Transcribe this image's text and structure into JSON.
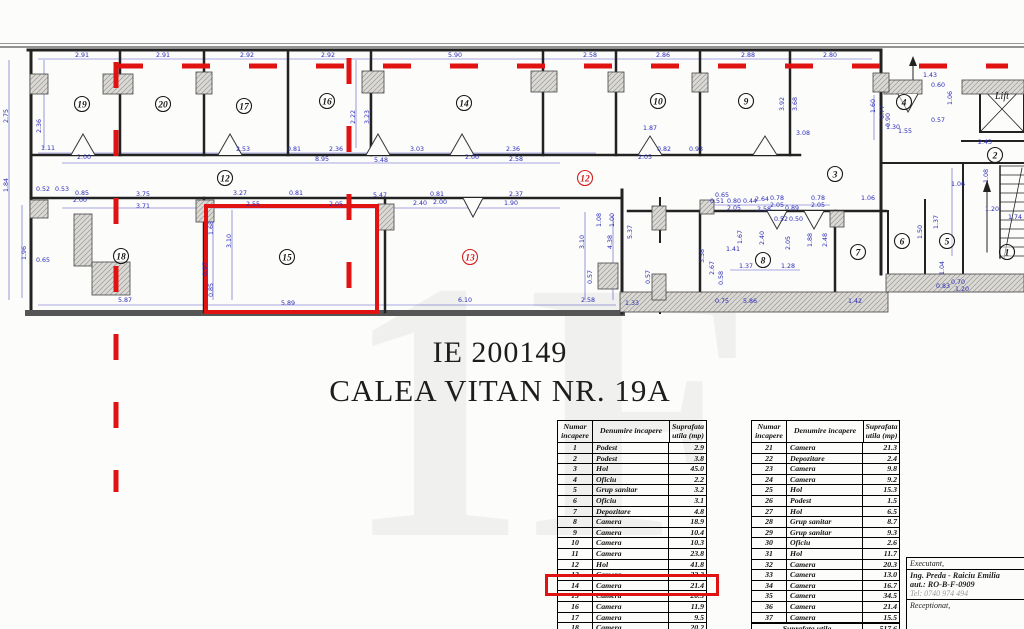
{
  "title": {
    "line1": "IE 200149",
    "line2": "CALEA VITAN NR. 19A"
  },
  "watermark": "1F",
  "colors": {
    "dim_blue": "#2a2ab8",
    "red": "#e01212",
    "wall": "#222222"
  },
  "plan": {
    "lift_label": "Lift",
    "rooms": [
      {
        "n": "19",
        "x": 82,
        "y": 104
      },
      {
        "n": "20",
        "x": 163,
        "y": 104
      },
      {
        "n": "17",
        "x": 244,
        "y": 106
      },
      {
        "n": "16",
        "x": 327,
        "y": 101
      },
      {
        "n": "14",
        "x": 464,
        "y": 103
      },
      {
        "n": "10",
        "x": 658,
        "y": 101
      },
      {
        "n": "9",
        "x": 746,
        "y": 101
      },
      {
        "n": "4",
        "x": 904,
        "y": 102
      },
      {
        "n": "3",
        "x": 835,
        "y": 174
      },
      {
        "n": "2",
        "x": 995,
        "y": 155
      },
      {
        "n": "12",
        "x": 225,
        "y": 178
      },
      {
        "n": "18",
        "x": 121,
        "y": 256
      },
      {
        "n": "15",
        "x": 287,
        "y": 257
      },
      {
        "n": "8",
        "x": 763,
        "y": 260
      },
      {
        "n": "7",
        "x": 858,
        "y": 252
      },
      {
        "n": "6",
        "x": 902,
        "y": 241
      },
      {
        "n": "5",
        "x": 947,
        "y": 241
      },
      {
        "n": "1",
        "x": 1007,
        "y": 252
      }
    ],
    "red_rooms": [
      {
        "n": "12",
        "x": 585,
        "y": 178
      },
      {
        "n": "13",
        "x": 470,
        "y": 257
      }
    ],
    "dimensions": [
      [
        "2.91",
        82,
        57
      ],
      [
        "2.91",
        163,
        57
      ],
      [
        "2.92",
        247,
        57
      ],
      [
        "2.92",
        328,
        57
      ],
      [
        "5.90",
        455,
        57
      ],
      [
        "2.58",
        590,
        57
      ],
      [
        "2.86",
        663,
        57
      ],
      [
        "2.88",
        748,
        57
      ],
      [
        "2.80",
        830,
        57
      ],
      [
        "1.43",
        930,
        77
      ],
      [
        "0.60",
        938,
        87
      ],
      [
        "1.87",
        650,
        130
      ],
      [
        "3.08",
        803,
        135
      ],
      [
        "2.43",
        985,
        144
      ],
      [
        "1.30",
        893,
        129
      ],
      [
        "1.55",
        905,
        133
      ],
      [
        "0.57",
        938,
        122
      ],
      [
        "1.06",
        958,
        186
      ],
      [
        "1.11",
        48,
        150
      ],
      [
        "2.00",
        84,
        159
      ],
      [
        "2.53",
        243,
        151
      ],
      [
        "0.81",
        294,
        151
      ],
      [
        "2.36",
        336,
        151
      ],
      [
        "8.95",
        322,
        161
      ],
      [
        "5.48",
        381,
        162
      ],
      [
        "3.03",
        417,
        151
      ],
      [
        "2.00",
        472,
        159
      ],
      [
        "2.36",
        513,
        151
      ],
      [
        "2.58",
        516,
        161
      ],
      [
        "2.05",
        645,
        159
      ],
      [
        "0.82",
        664,
        151
      ],
      [
        "0.93",
        696,
        151
      ],
      [
        "0.52",
        43,
        191
      ],
      [
        "0.53",
        62,
        191
      ],
      [
        "0.85",
        82,
        195
      ],
      [
        "2.00",
        80,
        202
      ],
      [
        "3.75",
        143,
        196
      ],
      [
        "3.71",
        143,
        208
      ],
      [
        "3.27",
        240,
        195
      ],
      [
        "0.81",
        296,
        195
      ],
      [
        "2.55",
        253,
        206
      ],
      [
        "2.05",
        336,
        206
      ],
      [
        "5.47",
        380,
        197
      ],
      [
        "0.81",
        437,
        196
      ],
      [
        "2.00",
        440,
        204
      ],
      [
        "2.37",
        516,
        196
      ],
      [
        "1.90",
        511,
        205
      ],
      [
        "2.40",
        420,
        205
      ],
      [
        "0.65",
        722,
        197
      ],
      [
        "2.64",
        762,
        201
      ],
      [
        "2.58",
        764,
        211
      ],
      [
        "1.20",
        992,
        211
      ],
      [
        "1.74",
        1015,
        219
      ],
      [
        "0.51",
        717,
        203
      ],
      [
        "0.80",
        734,
        203
      ],
      [
        "0.44",
        750,
        203
      ],
      [
        "2.05",
        734,
        210
      ],
      [
        "0.78",
        777,
        200
      ],
      [
        "2.05",
        777,
        207
      ],
      [
        "0.89",
        792,
        210
      ],
      [
        "0.78",
        818,
        200
      ],
      [
        "2.05",
        818,
        207
      ],
      [
        "0.50",
        796,
        221
      ],
      [
        "0.52",
        781,
        221
      ],
      [
        "1.37",
        746,
        268
      ],
      [
        "1.28",
        788,
        268
      ],
      [
        "1.41",
        733,
        251
      ],
      [
        "1.06",
        868,
        200
      ],
      [
        "0.83",
        943,
        288
      ],
      [
        "1.20",
        962,
        291
      ],
      [
        "0.70",
        958,
        284
      ],
      [
        "5.87",
        125,
        302
      ],
      [
        "5.89",
        288,
        305
      ],
      [
        "6.10",
        465,
        302
      ],
      [
        "2.58",
        588,
        302
      ],
      [
        "1.33",
        632,
        305
      ],
      [
        "5.86",
        750,
        303
      ],
      [
        "1.42",
        855,
        303
      ],
      [
        "0.75",
        722,
        303
      ],
      [
        "0.65",
        43,
        262
      ],
      [
        "2.75",
        8,
        116,
        1
      ],
      [
        "1.84",
        8,
        185,
        1
      ],
      [
        "2.36",
        41,
        126,
        1
      ],
      [
        "1.96",
        26,
        253,
        1
      ],
      [
        "2.22",
        355,
        117,
        1
      ],
      [
        "3.23",
        369,
        117,
        1
      ],
      [
        "1.68",
        213,
        228,
        1
      ],
      [
        "3.10",
        231,
        241,
        1
      ],
      [
        "0.97",
        207,
        269,
        1
      ],
      [
        "0.85",
        213,
        290,
        1
      ],
      [
        "1.08",
        601,
        220,
        1
      ],
      [
        "1.00",
        614,
        220,
        1
      ],
      [
        "0.57",
        592,
        277,
        1
      ],
      [
        "0.57",
        650,
        277,
        1
      ],
      [
        "3.10",
        584,
        242,
        1
      ],
      [
        "4.38",
        612,
        242,
        1
      ],
      [
        "5.37",
        632,
        232,
        1
      ],
      [
        "3.92",
        784,
        104,
        1
      ],
      [
        "3.68",
        797,
        104,
        1
      ],
      [
        "1.60",
        875,
        106,
        1
      ],
      [
        "0.90",
        890,
        120,
        1
      ],
      [
        "0.77",
        884,
        112,
        1
      ],
      [
        "1.06",
        952,
        98,
        1
      ],
      [
        "2.40",
        764,
        238,
        1
      ],
      [
        "2.05",
        790,
        243,
        1
      ],
      [
        "1.88",
        812,
        240,
        1
      ],
      [
        "2.48",
        827,
        240,
        1
      ],
      [
        "1.67",
        742,
        237,
        1
      ],
      [
        "3.58",
        704,
        256,
        1
      ],
      [
        "2.67",
        714,
        268,
        1
      ],
      [
        "0.58",
        723,
        278,
        1
      ],
      [
        "1.37",
        938,
        222,
        1
      ],
      [
        "1.50",
        922,
        232,
        1
      ],
      [
        "1.08",
        988,
        176,
        1
      ],
      [
        "1.04",
        944,
        268,
        1
      ]
    ]
  },
  "tables": {
    "headers": [
      "Numar incapere",
      "Denumire incapere",
      "Suprafata utila (mp)"
    ],
    "left_rows": [
      [
        "1",
        "Podest",
        "2.9"
      ],
      [
        "2",
        "Podest",
        "3.8"
      ],
      [
        "3",
        "Hol",
        "45.0"
      ],
      [
        "4",
        "Oficiu",
        "2.2"
      ],
      [
        "5",
        "Grup sanitar",
        "3.2"
      ],
      [
        "6",
        "Oficiu",
        "3.1"
      ],
      [
        "7",
        "Depozitare",
        "4.8"
      ],
      [
        "8",
        "Camera",
        "18.9"
      ],
      [
        "9",
        "Camera",
        "10.4"
      ],
      [
        "10",
        "Camera",
        "10.3"
      ],
      [
        "11",
        "Camera",
        "23.8"
      ],
      [
        "12",
        "Hol",
        "41.8"
      ],
      [
        "13",
        "Camera",
        "22.3"
      ],
      [
        "14",
        "Camera",
        "21.4"
      ],
      [
        "15",
        "Camera",
        "20.5"
      ],
      [
        "16",
        "Camera",
        "11.9"
      ],
      [
        "17",
        "Camera",
        "9.5"
      ],
      [
        "18",
        "Camera",
        "20.2"
      ],
      [
        "19",
        "Camera",
        "11.3"
      ]
    ],
    "right_rows": [
      [
        "21",
        "Camera",
        "21.3"
      ],
      [
        "22",
        "Depozitare",
        "2.4"
      ],
      [
        "23",
        "Camera",
        "9.8"
      ],
      [
        "24",
        "Camera",
        "9.2"
      ],
      [
        "25",
        "Hol",
        "15.3"
      ],
      [
        "26",
        "Podest",
        "1.5"
      ],
      [
        "27",
        "Hol",
        "6.5"
      ],
      [
        "28",
        "Grup sanitar",
        "8.7"
      ],
      [
        "29",
        "Grup sanitar",
        "9.3"
      ],
      [
        "30",
        "Oficiu",
        "2.6"
      ],
      [
        "31",
        "Hol",
        "11.7"
      ],
      [
        "32",
        "Camera",
        "20.3"
      ],
      [
        "33",
        "Camera",
        "13.0"
      ],
      [
        "34",
        "Camera",
        "16.7"
      ],
      [
        "35",
        "Camera",
        "34.5"
      ],
      [
        "36",
        "Camera",
        "21.4"
      ],
      [
        "37",
        "Camera",
        "15.5"
      ]
    ],
    "right_footer": {
      "label": "Suprafata utila",
      "value": "517.6"
    },
    "highlighted_row": "15"
  },
  "executant": {
    "line1": "Executant,",
    "name": "Ing. Preda - Raiciu Emilia",
    "aut": "aut.: RO-B-F-0909",
    "tel": "Tel: 0740 974 494",
    "line2": "Receptionat,"
  }
}
